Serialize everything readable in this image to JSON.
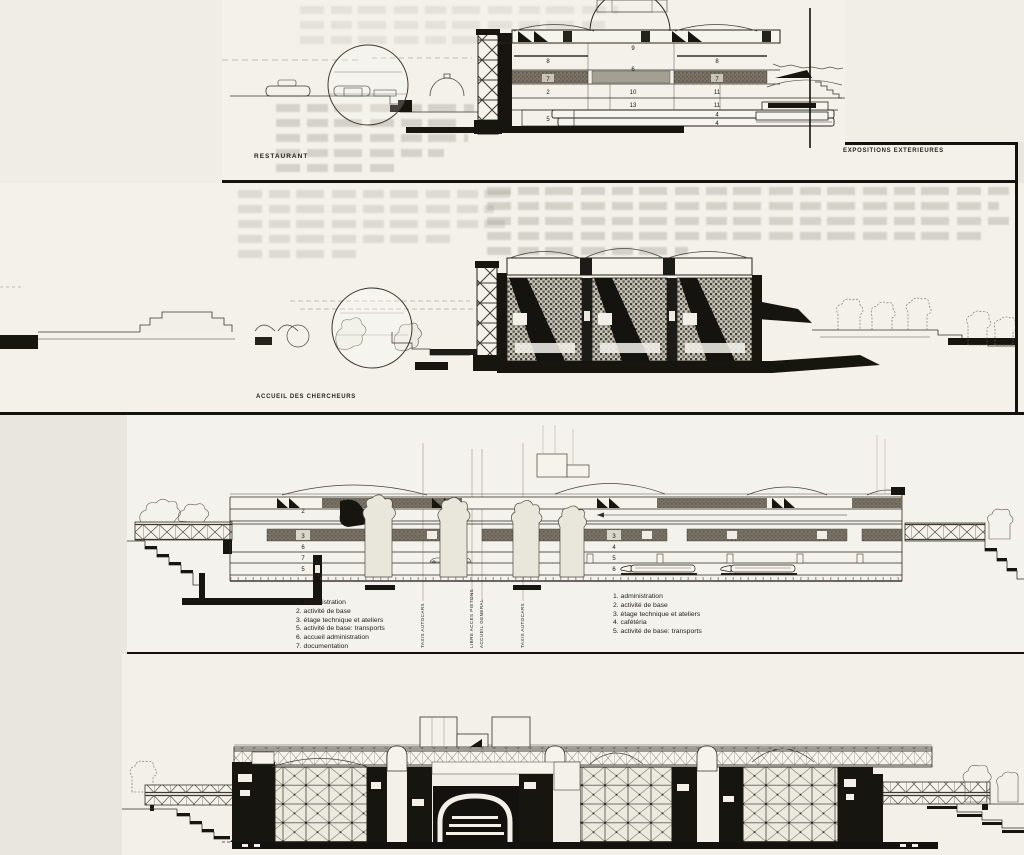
{
  "page": {
    "background": "#e8e6df",
    "panel_background": "#f3f1ea",
    "ink": "#141210",
    "gray_band": "#7b7368"
  },
  "captions": {
    "restaurant": "RESTAURANT",
    "expositions_exterieures": "EXPOSITIONS EXTERIEURES",
    "accueil_des_chercheurs": "ACCUEIL DES CHERCHEURS"
  },
  "section1": {
    "floor_numbers": [
      "9",
      "8",
      "6",
      "8",
      "7",
      "7",
      "2",
      "10",
      "11",
      "13",
      "11",
      "5",
      "4",
      "4"
    ]
  },
  "section3": {
    "left_floor_numbers": [
      "2",
      "3",
      "6",
      "7",
      "5"
    ],
    "right_floor_numbers": [
      "3",
      "4",
      "5",
      "6"
    ],
    "flow_labels": [
      "TAXIS AUTOCARS",
      "LIBRE ACCES PIETONS",
      "ACCUEIL GENERAL",
      "TAXIS AUTOCARS"
    ],
    "legend_left": [
      "1. administration",
      "2. activité de base",
      "3. étage technique et ateliers",
      "5. activité de base: transports",
      "6. accueil administration",
      "7. documentation"
    ],
    "legend_right": [
      "1. administration",
      "2. activité de base",
      "3. étage technique et ateliers",
      "4. cafétéria",
      "5. activité de base: transports"
    ]
  }
}
